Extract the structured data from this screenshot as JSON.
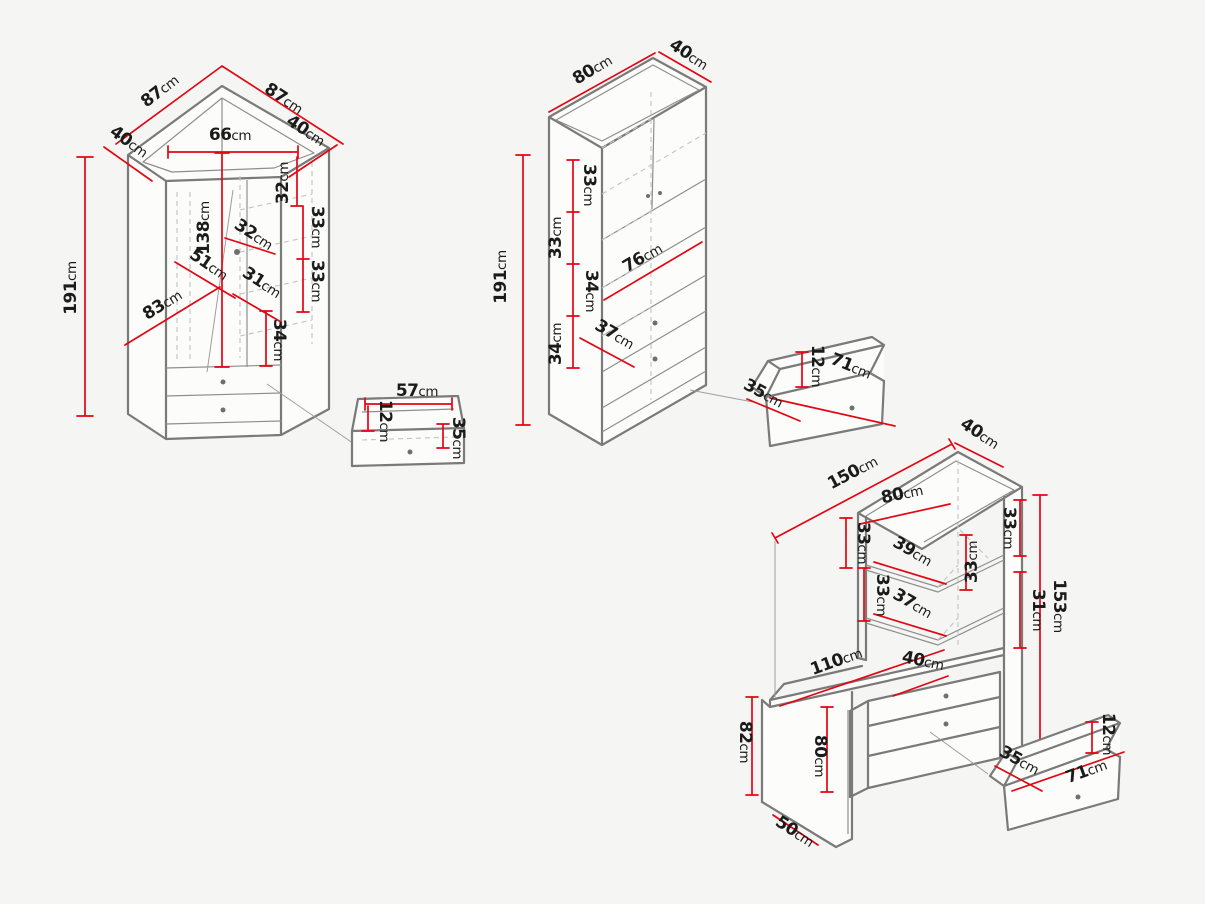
{
  "units": "cm",
  "colors": {
    "background": "#f5f5f3",
    "dimension_red": "#e30613",
    "outline_gray": "#7a7a7a",
    "hidden_gray": "#c3c3c3",
    "label_black": "#1b1b1b"
  },
  "wardrobe": {
    "name": "corner-wardrobe",
    "top_left": "87",
    "top_right": "87",
    "side_left": "40",
    "side_right": "40",
    "front_width": "66",
    "interior_height": "138",
    "height": "191",
    "door_diagonal": "83",
    "inner_diag": "51",
    "shelf_width_32": "32",
    "shelf_width_31": "31",
    "shelf_col_32": "32",
    "shelf_col_33a": "33",
    "shelf_col_33b": "33",
    "shelf_col_34": "34",
    "drawer": {
      "width": "57",
      "height": "12",
      "depth": "35"
    }
  },
  "bookcase": {
    "name": "bookcase",
    "width": "80",
    "depth": "40",
    "height": "191",
    "shelf_33a": "33",
    "shelf_33b": "33",
    "shelf_34a": "34",
    "shelf_34b": "34",
    "shelf_width": "76",
    "bottom_width": "37",
    "drawer": {
      "width": "71",
      "height": "12",
      "depth": "35"
    }
  },
  "desk": {
    "name": "corner-desk-with-hutch",
    "total_width": "150",
    "top_depth": "40",
    "hutch_width": "80",
    "shelf_33a": "33",
    "shelf_33b": "33",
    "shelf_33c": "33",
    "shelf_33d": "33",
    "shelf_width_39": "39",
    "shelf_width_37": "37",
    "shelf_31": "31",
    "total_height": "153",
    "desk_length": "110",
    "drawer_unit_width": "40",
    "desk_height": "82",
    "leg_height": "80",
    "base_depth": "50",
    "drawer": {
      "width": "71",
      "height": "12",
      "depth": "35"
    }
  }
}
